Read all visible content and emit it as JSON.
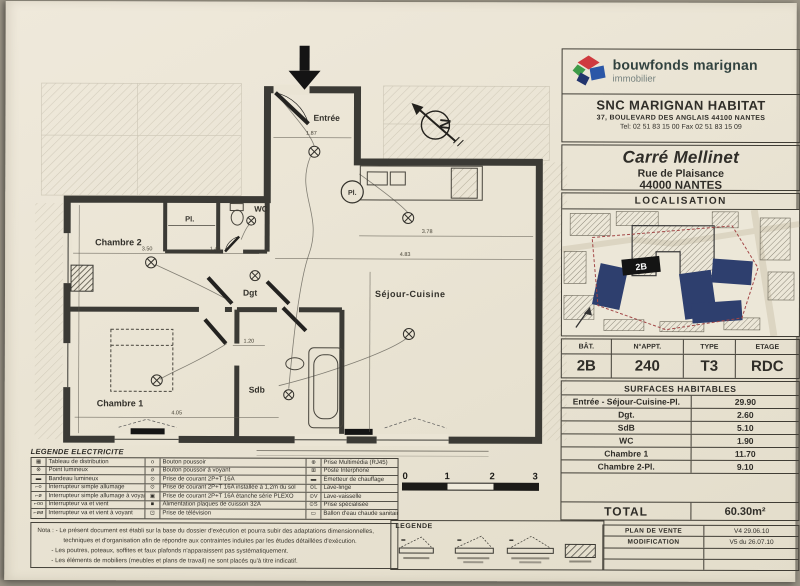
{
  "header": {
    "brand": "bouwfonds marignan",
    "brand_sub": "immobilier",
    "company": "SNC MARIGNAN HABITAT",
    "address": "37, BOULEVARD DES ANGLAIS  44100 NANTES",
    "phone": "Tel: 02 51 83 15 00  Fax 02 51 83 15 09"
  },
  "project": {
    "name": "Carré Mellinet",
    "street": "Rue de Plaisance",
    "city": "44000 NANTES"
  },
  "localisation": {
    "title": "LOCALISATION",
    "building_label": "2B"
  },
  "unit": {
    "headers": [
      "BÂT.",
      "N°APPT.",
      "TYPE",
      "ETAGE"
    ],
    "values": [
      "2B",
      "240",
      "T3",
      "RDC"
    ]
  },
  "surfaces": {
    "title": "SURFACES HABITABLES",
    "rows": [
      {
        "label": "Entrée - Séjour-Cuisine-Pl.",
        "value": "29.90"
      },
      {
        "label": "Dgt.",
        "value": "2.60"
      },
      {
        "label": "SdB",
        "value": "5.10"
      },
      {
        "label": "WC",
        "value": "1.90"
      },
      {
        "label": "Chambre 1",
        "value": "11.70"
      },
      {
        "label": "Chambre 2-Pl.",
        "value": "9.10"
      }
    ],
    "total_label": "TOTAL",
    "total_value": "60.30m²"
  },
  "revision": {
    "rows": [
      {
        "label": "PLAN DE VENTE",
        "value": "V4 29.06.10"
      },
      {
        "label": "MODIFICATION",
        "value": "V5 du 26.07.10"
      },
      {
        "label": "",
        "value": ""
      },
      {
        "label": "",
        "value": ""
      }
    ]
  },
  "plan": {
    "entrance_label": "Entrée",
    "rooms": {
      "chambre2": "Chambre 2",
      "chambre1": "Chambre 1",
      "wc": "WC",
      "dgt": "Dgt",
      "sdb": "Sdb",
      "sejour": "Séjour-Cuisine",
      "placard": "Pl.",
      "placard_circle": "Pl."
    },
    "compass": "N",
    "dimensions": [
      "1.87",
      "3.50",
      "1.40",
      "3.78",
      "4.83",
      "1.20",
      "4.05"
    ],
    "scale_ticks": [
      "0",
      "1",
      "2",
      "3"
    ]
  },
  "legende_electricite": {
    "title": "LEGENDE ELECTRICITE",
    "col1": [
      {
        "sym": "▦",
        "label": "Tableau de distribution"
      },
      {
        "sym": "⊗",
        "label": "Point lumineux"
      },
      {
        "sym": "▬",
        "label": "Bandeau lumineux"
      },
      {
        "sym": "⌐o",
        "label": "Interrupteur simple allumage"
      },
      {
        "sym": "⌐ø",
        "label": "Interrupteur simple allumage à voyant"
      },
      {
        "sym": "⌐oo",
        "label": "Interrupteur va et vient"
      },
      {
        "sym": "⌐øø",
        "label": "Interrupteur va et vient à voyant"
      }
    ],
    "col2": [
      {
        "sym": "o",
        "label": "Bouton poussoir"
      },
      {
        "sym": "ø",
        "label": "Bouton poussoir à voyant"
      },
      {
        "sym": "⊙",
        "label": "Prise de courant 2P+T 16A"
      },
      {
        "sym": "⊙",
        "label": "Prise de courant 2P+T 16A installée à 1,2m du sol"
      },
      {
        "sym": "▣",
        "label": "Prise de courant 2P+T 16A étanche série PLEXO"
      },
      {
        "sym": "■",
        "label": "Alimentation plaques de cuisson 32A"
      },
      {
        "sym": "⊡",
        "label": "Prise de télévision"
      }
    ],
    "col3": [
      {
        "sym": "⊕",
        "label": "Prise Multimédia (RJ45)"
      },
      {
        "sym": "⊞",
        "label": "Poste Interphone"
      },
      {
        "sym": "▬",
        "label": "Emetteur de chauffage"
      },
      {
        "sym": "⊙L",
        "label": "Lave-linge"
      },
      {
        "sym": "⊙V",
        "label": "Lave-vaisselle"
      },
      {
        "sym": "⊙S",
        "label": "Prise spécialisée"
      },
      {
        "sym": "▭",
        "label": "Ballon d'eau chaude sanitaire"
      }
    ]
  },
  "nota": {
    "label": "Nota :",
    "lines": [
      "- Le présent document est établi sur la base du dossier d'exécution et pourra subir des adaptations dimensionnelles,",
      "techniques et d'organisation afin de répondre aux contraintes induites par les études détaillées d'exécution.",
      "- Les poutres, poteaux, soffites et faux plafonds n'apparaissent pas systématiquement.",
      "- Les éléments de mobiliers (meubles et plans de travail) ne sont placés qu'à titre indicatif."
    ]
  },
  "legende_bas": {
    "title": "LEGENDE"
  },
  "colors": {
    "paper": "#eae4d4",
    "ink": "#2f2d28",
    "wall": "#3b3a35",
    "logo_red": "#cf3a3f",
    "logo_green": "#3e9b49",
    "logo_blue": "#2b57a7",
    "logo_navy": "#22346d",
    "map_navy": "#2e3f6e",
    "map_red": "#a34848",
    "highlight_black": "#141414"
  }
}
